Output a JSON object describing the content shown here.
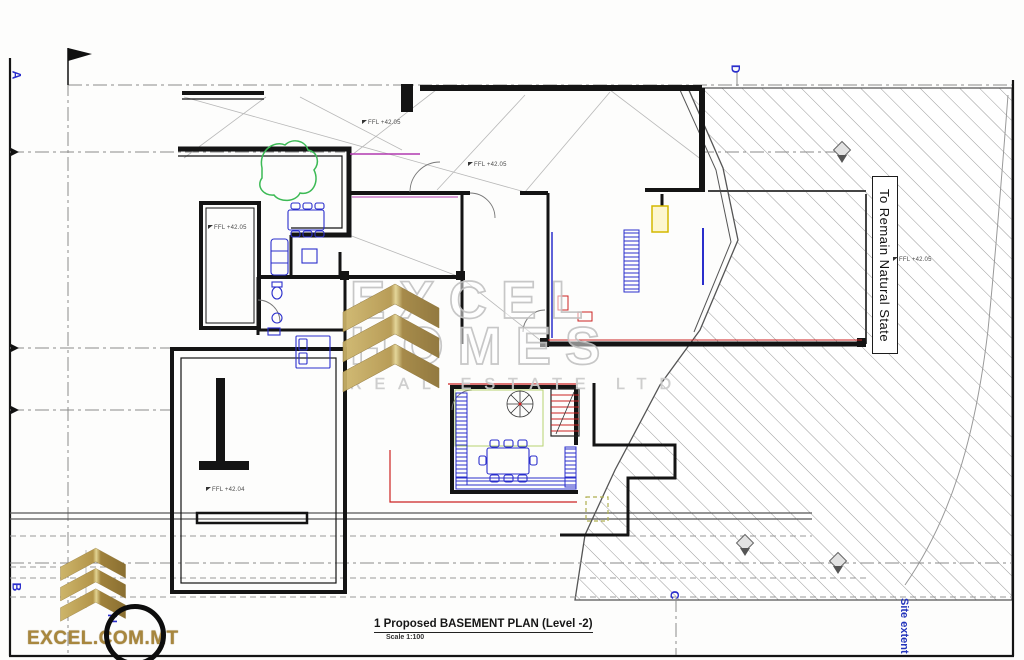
{
  "document": {
    "plan_title": "1 Proposed BASEMENT PLAN (Level -2)",
    "plan_scale": "Scale 1:100"
  },
  "watermark": {
    "brand_line1": "EXCEL",
    "brand_line2": "HOMES",
    "brand_line3": "REAL ESTATE LTD"
  },
  "branding": {
    "website": "EXCEL.COM.MT",
    "north_label": "N"
  },
  "grid_markers": {
    "a": "A",
    "b": "B",
    "c": "C",
    "d": "D"
  },
  "labels": {
    "natural_state": "To Remain Natural State",
    "site_extent": "Site extent"
  },
  "ffl_markers": [
    {
      "label": "FFL +42.05"
    },
    {
      "label": "FFL +42.05"
    },
    {
      "label": "FFL +42.05"
    },
    {
      "label": "FFL +42.05"
    },
    {
      "label": "FFL +42.04"
    }
  ],
  "colors": {
    "logo_gold": "#b3954a",
    "accent_red": "#cc2222",
    "annotation_blue": "#2a2ecc",
    "tree_green": "#3cba55",
    "hatch_gray": "#9a9a9a"
  }
}
